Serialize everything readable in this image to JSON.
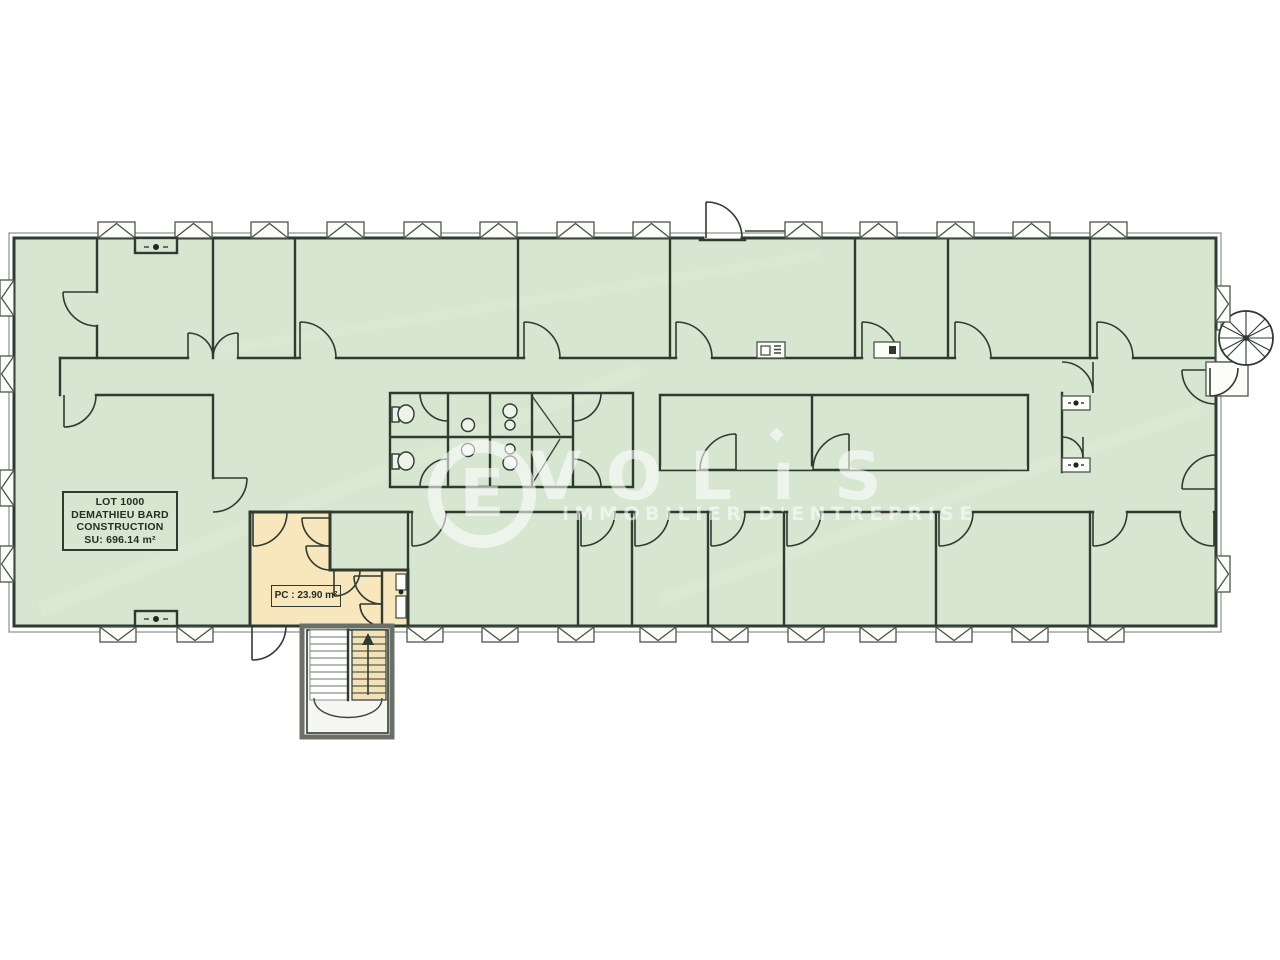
{
  "plan": {
    "lot_label": {
      "line1": "LOT 1000",
      "line2": "DEMATHIEU BARD",
      "line3": "CONSTRUCTION",
      "line4": "SU: 696.14 m²"
    },
    "pc_label": "PC : 23.90 m²"
  },
  "watermark": {
    "letters": [
      "E",
      "V",
      "O",
      "L",
      "ı",
      "S"
    ],
    "i_dot": "◆",
    "subtitle": "IMMOBILIER D'ENTREPRISE"
  },
  "colors": {
    "background": "#ffffff",
    "room_fill": "#d6e6d0",
    "lot_highlight_fill": "#f8e6bd",
    "stair_flight_fill": "#f3e2b8",
    "wall_line": "#2f3b31",
    "outer_offset_line": "#8b908a",
    "watermark_white": "#ffffff"
  },
  "icons": {
    "window": "gabled-rect",
    "door": "quarter-arc",
    "stair_up_arrow": "triangle-up",
    "survey_point": "dot-with-ticks",
    "spiral_staircase": "spoked-circle",
    "copier": "small-rect-appliance",
    "toilet": "oval-bowl",
    "sink": "circle-basin"
  }
}
